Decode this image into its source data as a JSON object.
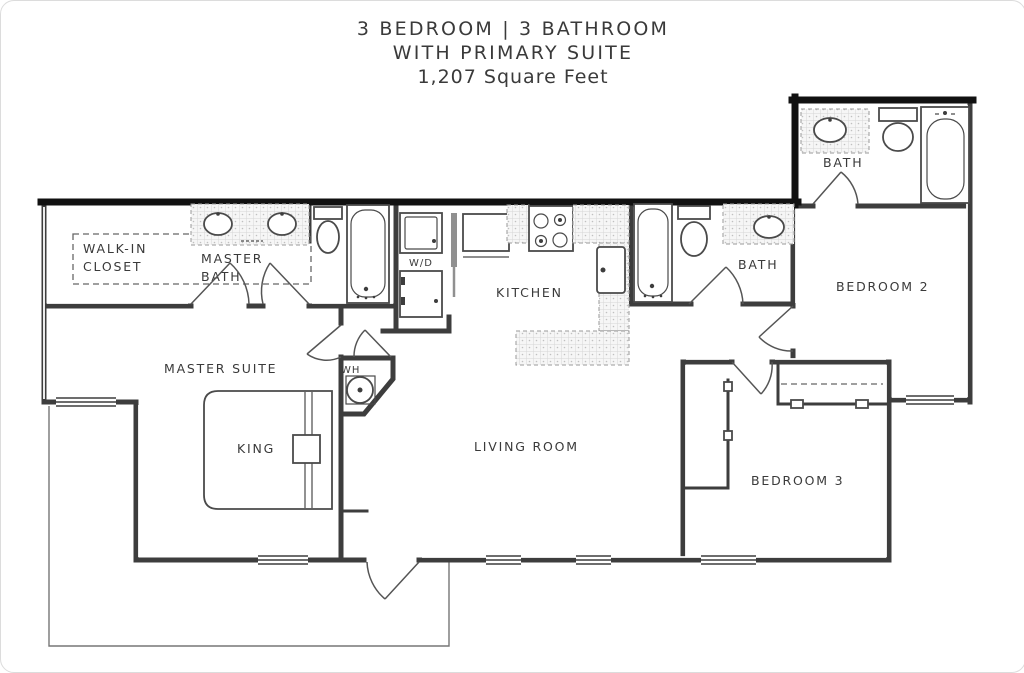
{
  "title": {
    "line1": "3 BEDROOM  |  3 BATHROOM",
    "line2": "WITH PRIMARY SUITE",
    "line3": "1,207 Square Feet"
  },
  "rooms": {
    "walk_in_closet_line1": "WALK-IN",
    "walk_in_closet_line2": "CLOSET",
    "master_bath_line1": "MASTER",
    "master_bath_line2": "BATH",
    "master_suite": "MASTER SUITE",
    "king": "KING",
    "water_heater": "WH",
    "washer_dryer": "W/D",
    "kitchen": "KITCHEN",
    "bath_hall": "BATH",
    "bath_upper": "BATH",
    "bedroom2": "BEDROOM 2",
    "bedroom3": "BEDROOM 3",
    "living_room": "LIVING ROOM"
  },
  "colors": {
    "wall": "#3d3d3d",
    "thick_wall": "#111111",
    "line": "#4a4a4a",
    "tile_line": "#c9c9c9",
    "text": "#3a3a3a",
    "background": "#ffffff"
  }
}
